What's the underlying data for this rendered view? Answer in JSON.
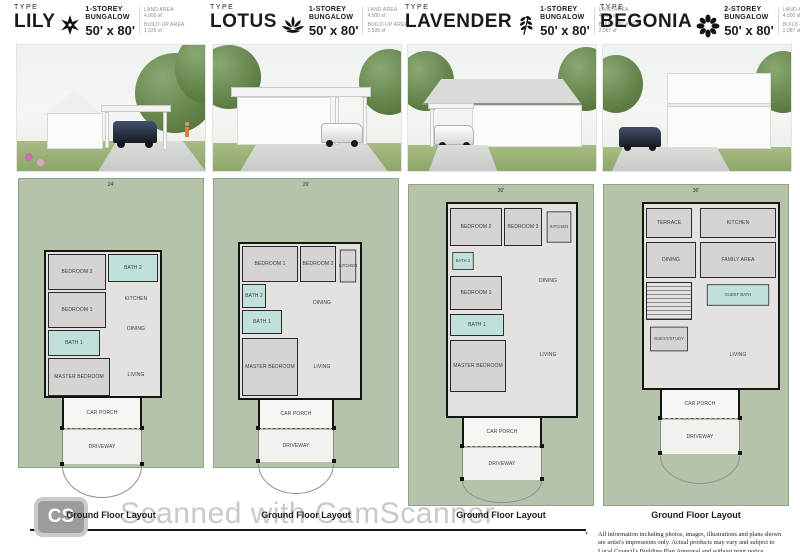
{
  "types": [
    {
      "type_label": "TYPE",
      "name": "LILY",
      "icon": "lily-flower-icon",
      "storey": "1-STOREY",
      "category": "BUNGALOW",
      "size": "50' x 80'",
      "land_area_label": "LAND AREA",
      "land_area": "4,000 sf",
      "buildup_label": "BUILD-UP AREA",
      "buildup": "1,339 sf",
      "plan": {
        "top_dim": "24'",
        "rooms": [
          "BEDROOM 2",
          "BATH 2",
          "KITCHEN",
          "BEDROOM 1",
          "DINING",
          "BATH 1",
          "MASTER BEDROOM",
          "LIVING"
        ],
        "car_porch": "CAR PORCH",
        "driveway": "DRIVEWAY"
      },
      "caption": "Ground Floor Layout"
    },
    {
      "type_label": "TYPE",
      "name": "LOTUS",
      "icon": "lotus-flower-icon",
      "storey": "1-STOREY",
      "category": "BUNGALOW",
      "size": "50' x 80'",
      "land_area_label": "LAND AREA",
      "land_area": "4,000 sf",
      "buildup_label": "BUILD-UP AREA",
      "buildup": "1,599 sf",
      "plan": {
        "top_dim": "26'",
        "rooms": [
          "BEDROOM 1",
          "BEDROOM 2",
          "KITCHEN",
          "BATH 2",
          "BATH 1",
          "DINING",
          "MASTER BEDROOM",
          "LIVING"
        ],
        "car_porch": "CAR PORCH",
        "driveway": "DRIVEWAY"
      },
      "caption": "Ground Floor Layout"
    },
    {
      "type_label": "TYPE",
      "name": "LAVENDER",
      "icon": "lavender-sprig-icon",
      "storey": "1-STOREY",
      "category": "BUNGALOW",
      "size": "50' x 80'",
      "land_area_label": "LAND AREA",
      "land_area": "4,000 sf",
      "buildup_label": "BUILD-UP AREA",
      "buildup": "2,067 sf",
      "plan": {
        "top_dim": "30'",
        "rooms": [
          "BEDROOM 2",
          "BEDROOM 3",
          "KITCHEN",
          "BATH 2",
          "BEDROOM 1",
          "DINING",
          "BATH 1",
          "MASTER BEDROOM",
          "LIVING"
        ],
        "car_porch": "CAR PORCH",
        "driveway": "DRIVEWAY"
      },
      "caption": "Ground Floor Layout"
    },
    {
      "type_label": "TYPE",
      "name": "BEGONIA",
      "icon": "begonia-flower-icon",
      "storey": "2-STOREY",
      "category": "BUNGALOW",
      "size": "50' x 80'",
      "land_area_label": "LAND AREA",
      "land_area": "4,000 sf",
      "buildup_label": "BUILD-UP AREA",
      "buildup": "2,087 sf",
      "plan": {
        "top_dim": "36'",
        "rooms": [
          "TERRACE",
          "KITCHEN",
          "DINING",
          "FAMILY AREA",
          "GUEST BATH",
          "GUEST/STUDY",
          "LIVING"
        ],
        "car_porch": "CAR PORCH",
        "driveway": "DRIVEWAY"
      },
      "caption": "Ground Floor Layout"
    }
  ],
  "watermark": {
    "badge_text": "CS",
    "text": "Scanned with CamScanner"
  },
  "disclaimer": {
    "marker": "*",
    "line1": "All information including photos, images, illustrations and plans shown",
    "line2": "are artist's impressions only. Actual products may vary and subject to",
    "line3": "Local Council's Building Plan Approval and without prior notice."
  },
  "colors": {
    "plan_panel_green": "#b5c3ab",
    "bathroom_teal": "#bfe0db",
    "room_gray": "#d5d4d1",
    "watermark_gray": "#c9c9c9"
  }
}
